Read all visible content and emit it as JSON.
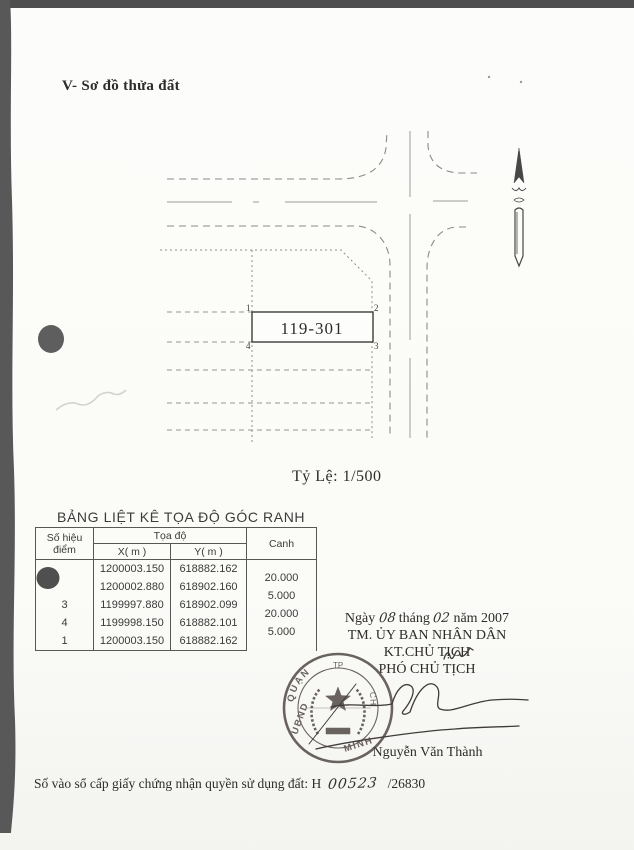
{
  "doc": {
    "section_title": "V- Sơ đồ thửa đất",
    "scale_label": "Tỷ Lệ: 1/500",
    "registry": {
      "label": "Số vào sổ cấp giấy chứng nhận quyền sử dụng đất:",
      "prefix": "H",
      "handwritten_number": "00523",
      "suffix": "/26830"
    }
  },
  "diagram": {
    "parcel_label": "119-301",
    "corners": [
      "1",
      "2",
      "3",
      "4"
    ]
  },
  "table": {
    "title": "BẢNG LIỆT KÊ TỌA ĐỘ GÓC RANH",
    "headers": {
      "point_line1": "Số hiệu",
      "point_line2": "điểm",
      "coords": "Tọa độ",
      "x": "X( m )",
      "y": "Y( m )",
      "edge": "Canh"
    },
    "rows": [
      {
        "point": "",
        "x": "1200003.150",
        "y": "618882.162"
      },
      {
        "point": "",
        "x": "1200002.880",
        "y": "618902.160"
      },
      {
        "point": "3",
        "x": "1199997.880",
        "y": "618902.099"
      },
      {
        "point": "4",
        "x": "1199998.150",
        "y": "618882.101"
      },
      {
        "point": "1",
        "x": "1200003.150",
        "y": "618882.162"
      }
    ],
    "edges": [
      "20.000",
      "5.000",
      "20.000",
      "5.000"
    ]
  },
  "sig": {
    "date_prefix": "Ngày",
    "day": "08",
    "month_label": "tháng",
    "month": "02",
    "year_label": "năm 2007",
    "committee": "TM. ỦY BAN NHÂN DÂN",
    "signing_title": "KT.CHỦ TỊCH",
    "deputy_title": "PHÓ CHỦ TỊCH",
    "signer_name": "Nguyễn Văn Thành",
    "seal": {
      "arc_top": "QUẬN",
      "left_text": "UBND",
      "right_text": "MINH",
      "top_small": "TP",
      "side_text": "CH",
      "color": "#564e4b"
    }
  }
}
